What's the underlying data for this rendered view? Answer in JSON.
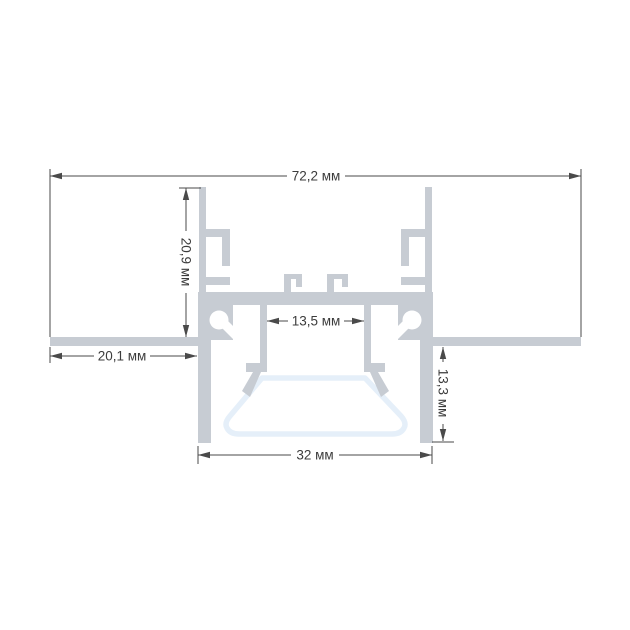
{
  "dimensions": {
    "overall_width": "72,2 мм",
    "wing_height": "20,9 мм",
    "led_channel_width": "13,5 мм",
    "flange_width": "20,1 мм",
    "recess_depth": "13,3 мм",
    "base_width": "32 мм"
  },
  "colors": {
    "profile_fill": "#c7ccd3",
    "diffuser_stroke": "#e5eff9",
    "diffuser_fill": "#ffffff",
    "dimension_line": "#4a4a4a",
    "dimension_text": "#3c3c3c",
    "background": "#ffffff"
  }
}
